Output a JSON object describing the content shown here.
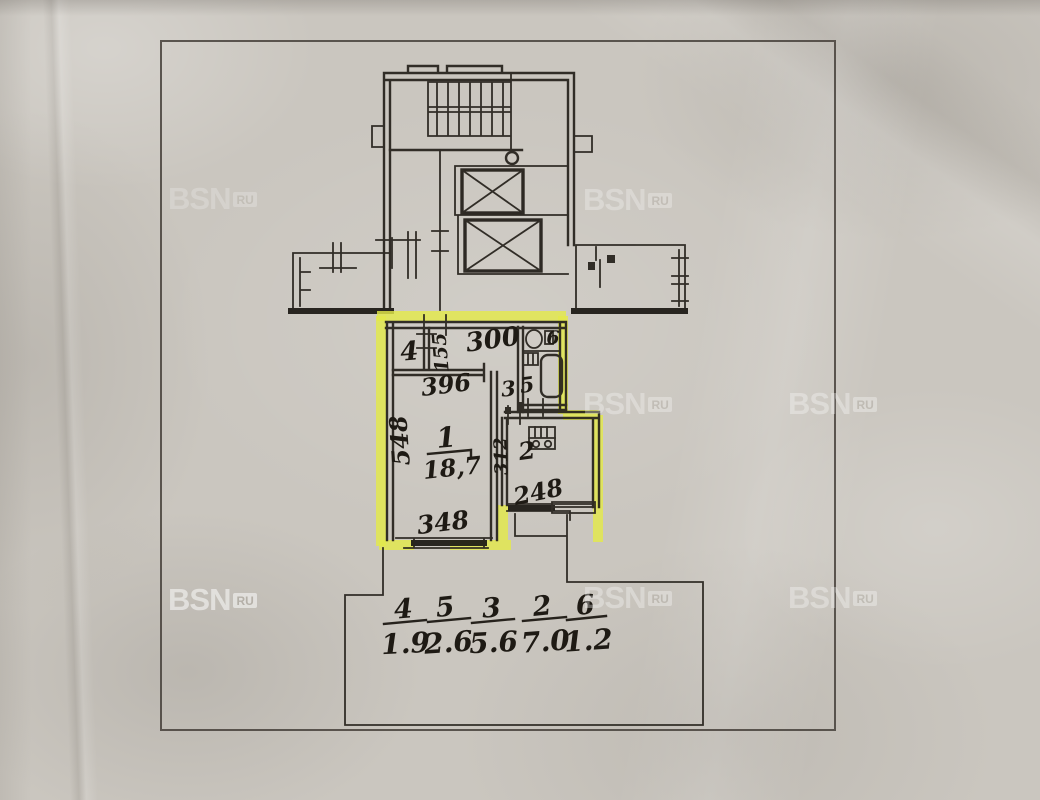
{
  "watermark": {
    "brand": "BSN",
    "suffix": "RU"
  },
  "plan": {
    "dim_hall_width": "300",
    "dim_closet": "155",
    "dim_room_top": "396",
    "dim_room_depth": "548",
    "dim_room_width": "348",
    "dim_kitchen_depth": "312",
    "dim_kitchen_width": "248",
    "label_room1": "1",
    "area_room1": "18,7",
    "label_kitchen": "2",
    "label_hall": "3",
    "label_closet": "4",
    "label_bath": "5",
    "label_wc": "6",
    "legend": [
      {
        "room": "4",
        "area": "1.9"
      },
      {
        "room": "5",
        "area": "2.6"
      },
      {
        "room": "3",
        "area": "5.6"
      },
      {
        "room": "2",
        "area": "7.0"
      },
      {
        "room": "6",
        "area": "1.2"
      }
    ],
    "colors": {
      "highlight": "#e3e94b",
      "ink": "#211d18",
      "paper": "#cac6bf",
      "watermark": "#ffffff"
    }
  }
}
